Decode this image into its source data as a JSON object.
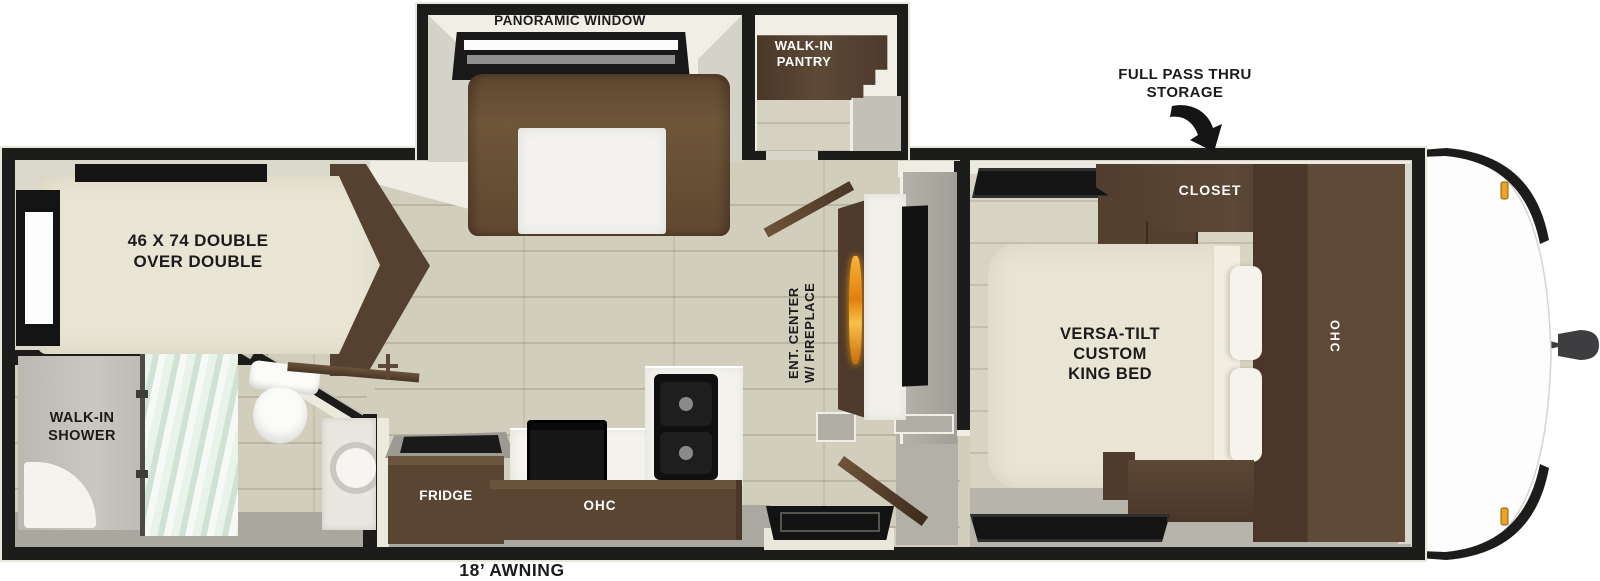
{
  "plan": {
    "type": "travel-trailer-floorplan",
    "labels": {
      "panoramic_window": "PANORAMIC WINDOW",
      "pantry": [
        "WALK-IN",
        "PANTRY"
      ],
      "storage": [
        "FULL PASS THRU",
        "STORAGE"
      ],
      "closet": "CLOSET",
      "bedroom_ohc": "OHC",
      "king_bed": [
        "VERSA-TILT",
        "CUSTOM",
        "KING BED"
      ],
      "double_bed": [
        "46 X 74 DOUBLE",
        "OVER DOUBLE"
      ],
      "shower": [
        "WALK-IN",
        "SHOWER"
      ],
      "ent_center": [
        "ENT. CENTER",
        "W/ FIREPLACE"
      ],
      "fridge": "FRIDGE",
      "kitchen_ohc": "OHC",
      "awning": "18’ AWNING"
    },
    "colors": {
      "wall_black": "#1c1c1b",
      "floor_wood": "#d2cebc",
      "floor_gray": "#b6b4ab",
      "cabinet_dark_wood": "#503d2d",
      "sofa_brown": "#6b5138",
      "bed_cream": "#e9e5d4",
      "shower_glass_teal": "#d8ead9",
      "flame_orange": "#e8920f",
      "marker_light_amber": "#eda424",
      "counter_white": "#f3f2ec"
    }
  }
}
